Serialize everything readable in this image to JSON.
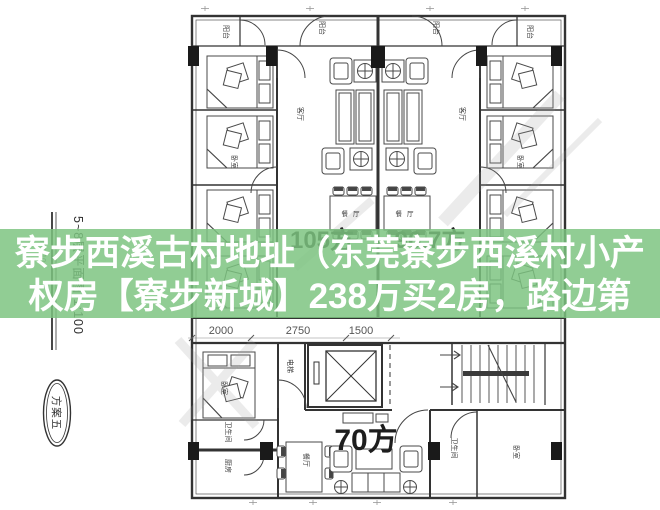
{
  "overlay": {
    "line1": "寮步西溪古村地址（东莞寮步西溪村小产",
    "line2": "权房【寮步新城】238万买2房，路边第",
    "band_color": "#7cc480",
    "text_color": "#ffffff"
  },
  "plan": {
    "title_vertical": "5~8层平面图 1:100",
    "area_note": "801.10",
    "stamp_label": "方案五",
    "unit_areas": {
      "left": "105方",
      "right": "96.7方",
      "bottom": "70方"
    },
    "dimensions": {
      "d1": "2000",
      "d2": "2750",
      "d3": "1500"
    },
    "rooms": {
      "balcony": "阳台",
      "bedroom": "卧室",
      "living": "客厅",
      "dining": "餐厅",
      "kitchen": "厨房",
      "bathroom": "卫生间",
      "elevator": "电梯"
    },
    "ink_color": "#3a3a3a"
  }
}
